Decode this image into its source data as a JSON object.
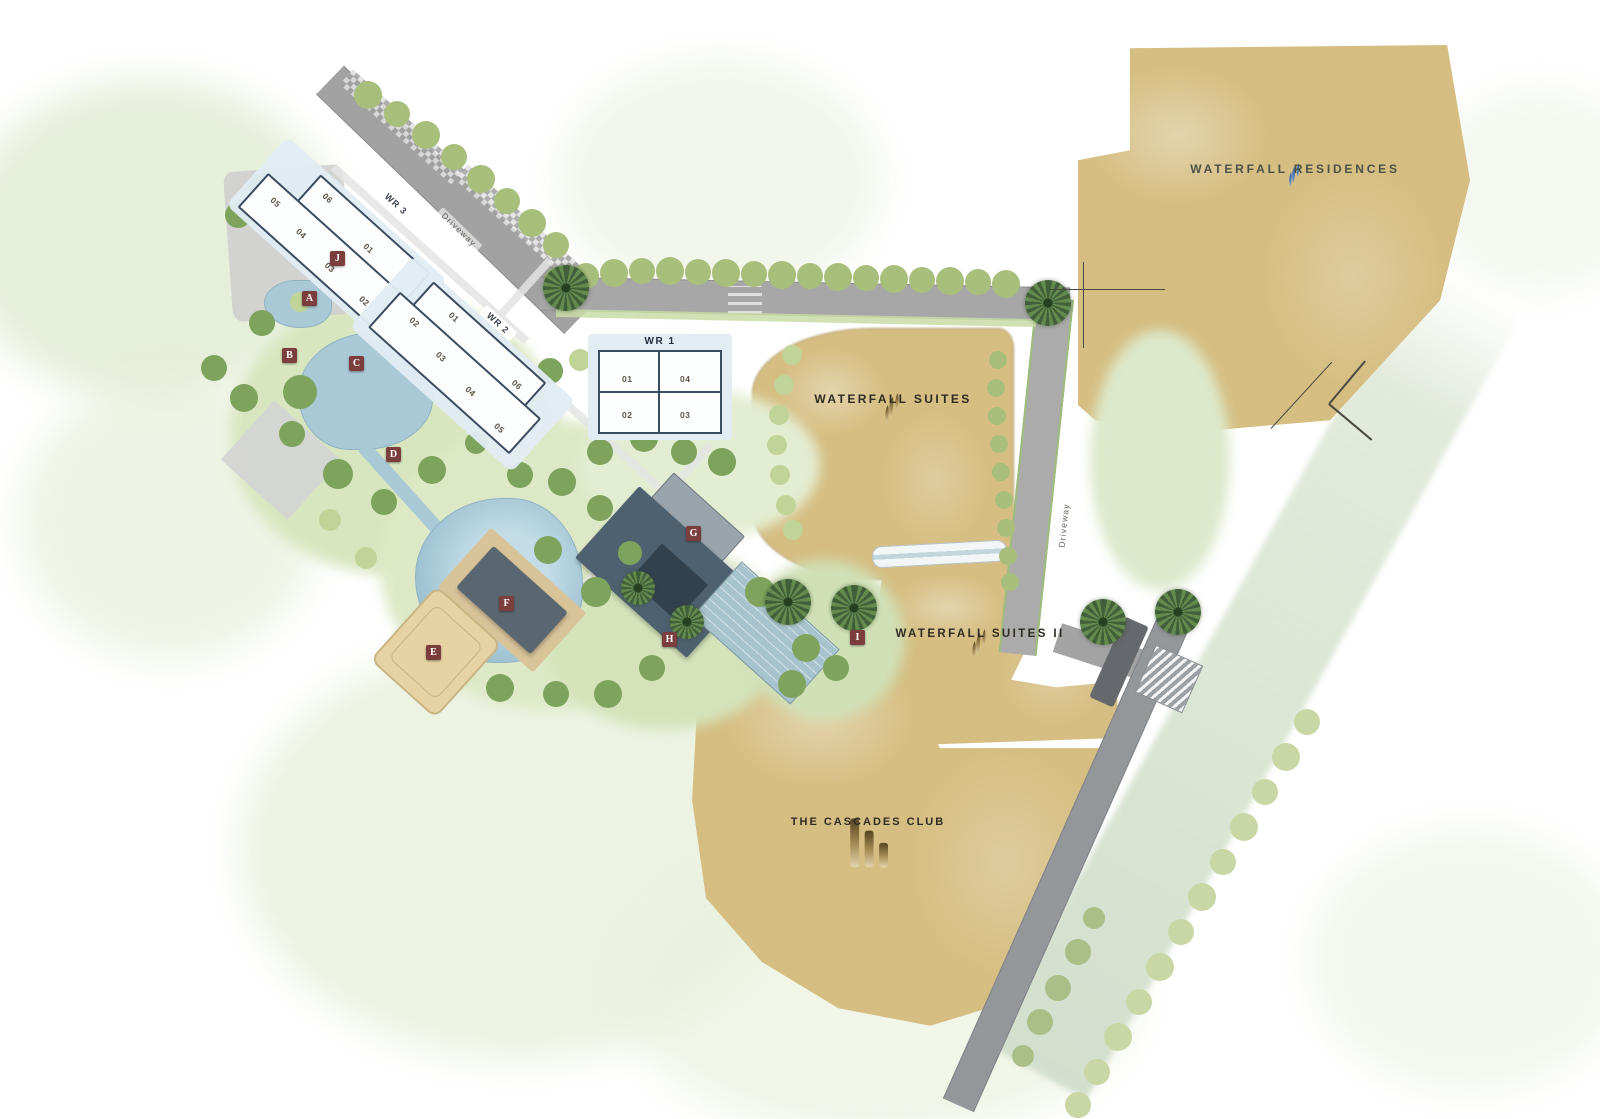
{
  "plots": [
    {
      "name": "WATERFALL RESIDENCES",
      "logo_icon": "flame-icon",
      "logo_color": "#3d6db0"
    },
    {
      "name": "WATERFALL SUITES",
      "logo_icon": "flame-icon",
      "logo_color": "#8a6f42"
    },
    {
      "name": "WATERFALL SUITES II",
      "logo_icon": "flame-icon",
      "logo_color": "#8a6f42"
    },
    {
      "name": "THE CASCADES CLUB",
      "logo_icon": "cascade-bars-icon",
      "logo_color": "#8a6f42"
    }
  ],
  "buildings": {
    "wr1": {
      "label": "WR 1",
      "units": [
        "01",
        "04",
        "02",
        "03"
      ]
    },
    "wr2": {
      "label": "WR 2",
      "units": [
        "01",
        "06",
        "02",
        "03",
        "04",
        "05"
      ]
    },
    "wr3": {
      "label": "WR 3",
      "units": [
        "05",
        "06",
        "04",
        "01",
        "03",
        "02"
      ]
    }
  },
  "road_labels": {
    "driveway": "Driveway"
  },
  "amenity_markers": [
    "A",
    "B",
    "C",
    "D",
    "E",
    "F",
    "G",
    "H",
    "I",
    "J"
  ],
  "palette": {
    "plot_tan": "#d6be82",
    "water_blue": "#a9c9d6",
    "marker_maroon": "#7c3e3c",
    "road_gray": "#a5a5a5",
    "tree_green": "#7da35c",
    "residences_text": "#4c5148",
    "label_dark": "#2f2b23"
  }
}
